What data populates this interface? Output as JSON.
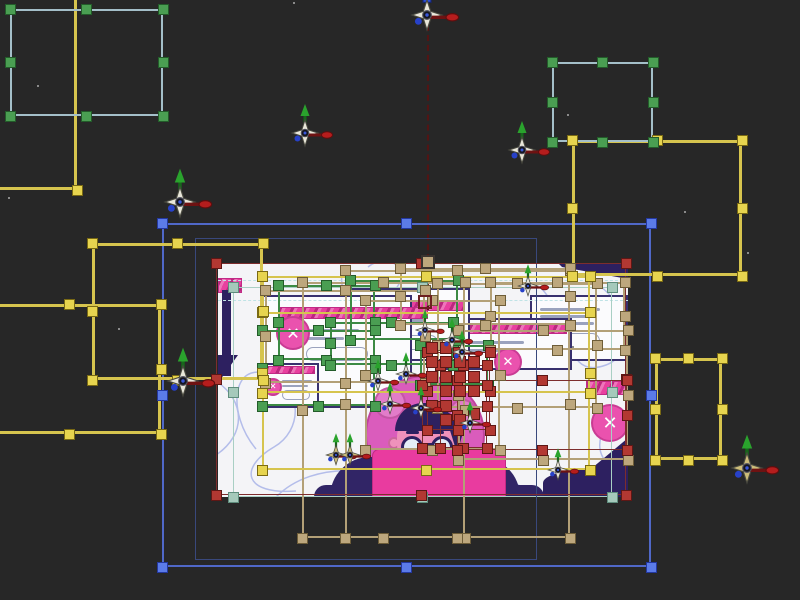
{
  "app": {
    "name": "animation-editor-viewport",
    "background": "#272727",
    "description": "composition viewport with multi-layer selection"
  },
  "artboard": {
    "x": 218,
    "y": 263,
    "w": 410,
    "h": 234,
    "fill": "#f4f4f7"
  },
  "palette": {
    "handle_green": {
      "fill": "#4a9e52",
      "border": "#235c2a"
    },
    "handle_yellow": {
      "fill": "#e7d44f",
      "border": "#7a6a14"
    },
    "handle_khaki": {
      "fill": "#bda77d",
      "border": "#6e5d38"
    },
    "handle_red": {
      "fill": "#b23832",
      "border": "#5e1715"
    },
    "handle_blue": {
      "fill": "#5b7be8",
      "border": "#2438a0"
    },
    "handle_teal": {
      "fill": "#a5c9bb",
      "border": "#5f8d7d"
    },
    "stroke_steel": "#a4bfc9",
    "stroke_yellow": "#d6c44e",
    "stroke_blue": "#5068c8",
    "stroke_navy": "#39487c",
    "stroke_khaki": "#b3a077",
    "stroke_green": "#3c8a44",
    "stroke_red": "#7d2d2d",
    "stroke_teal": "#a9cfc4"
  },
  "selection": {
    "boxes": [
      {
        "id": "teal-artboard-frame",
        "x": 233,
        "y": 287,
        "w": 379,
        "h": 210,
        "stroke": "#a9cfc4",
        "sw": 1,
        "handle": "handle_teal",
        "handles": "all"
      },
      {
        "id": "navy-inner-frame",
        "x": 195,
        "y": 238,
        "w": 342,
        "h": 322,
        "stroke": "#39487c",
        "sw": 1,
        "handle": "handle_blue",
        "handles": "none"
      },
      {
        "id": "green-box-1",
        "x": 278,
        "y": 285,
        "w": 97,
        "h": 75,
        "stroke": "#3c8a44",
        "sw": 2,
        "handle": "handle_green",
        "handles": "all"
      },
      {
        "id": "green-box-2",
        "x": 262,
        "y": 330,
        "w": 113,
        "h": 76,
        "stroke": "#3c8a44",
        "sw": 2,
        "handle": "handle_green",
        "handles": "all"
      },
      {
        "id": "green-box-3",
        "x": 330,
        "y": 322,
        "w": 123,
        "h": 43,
        "stroke": "#3c8a44",
        "sw": 2,
        "handle": "handle_green",
        "handles": "all"
      },
      {
        "id": "green-box-4",
        "x": 350,
        "y": 280,
        "w": 108,
        "h": 60,
        "stroke": "#3c8a44",
        "sw": 2,
        "handle": "handle_green",
        "handles": "corners"
      },
      {
        "id": "green-box-5",
        "x": 420,
        "y": 345,
        "w": 68,
        "h": 40,
        "stroke": "#3c8a44",
        "sw": 2,
        "handle": "handle_green",
        "handles": "corners"
      },
      {
        "id": "khaki-box-1",
        "x": 302,
        "y": 282,
        "w": 163,
        "h": 256,
        "stroke": "#b3a077",
        "sw": 2,
        "handle": "handle_khaki",
        "handles": "all"
      },
      {
        "id": "khaki-box-2",
        "x": 345,
        "y": 270,
        "w": 225,
        "h": 268,
        "stroke": "#b3a077",
        "sw": 2,
        "handle": "handle_khaki",
        "handles": "all"
      },
      {
        "id": "khaki-box-3",
        "x": 365,
        "y": 300,
        "w": 135,
        "h": 150,
        "stroke": "#b3a077",
        "sw": 2,
        "handle": "handle_khaki",
        "handles": "all"
      },
      {
        "id": "khaki-box-4",
        "x": 437,
        "y": 283,
        "w": 160,
        "h": 125,
        "stroke": "#b3a077",
        "sw": 2,
        "handle": "handle_khaki",
        "handles": "all"
      },
      {
        "id": "khaki-box-5",
        "x": 458,
        "y": 330,
        "w": 170,
        "h": 130,
        "stroke": "#b3a077",
        "sw": 2,
        "handle": "handle_khaki",
        "handles": "all"
      },
      {
        "id": "khaki-box-6",
        "x": 490,
        "y": 282,
        "w": 135,
        "h": 68,
        "stroke": "#b3a077",
        "sw": 2,
        "handle": "handle_khaki",
        "handles": "all"
      },
      {
        "id": "khaki-box-7",
        "x": 265,
        "y": 290,
        "w": 160,
        "h": 93,
        "stroke": "#b3a077",
        "sw": 2,
        "handle": "handle_khaki",
        "handles": "all"
      },
      {
        "id": "khaki-box-8",
        "x": 400,
        "y": 268,
        "w": 170,
        "h": 57,
        "stroke": "#b3a077",
        "sw": 2,
        "handle": "handle_khaki",
        "handles": "all"
      },
      {
        "id": "yellow-inner-1",
        "x": 262,
        "y": 276,
        "w": 328,
        "h": 194,
        "stroke": "#d6c44e",
        "sw": 2,
        "handle": "handle_yellow",
        "handles": "all"
      },
      {
        "id": "yellow-inner-2",
        "x": 262,
        "y": 312,
        "w": 328,
        "h": 81,
        "stroke": "#d6c44e",
        "sw": 2,
        "handle": "handle_yellow",
        "handles": "corners"
      },
      {
        "id": "red-artboard-selection",
        "x": 216,
        "y": 263,
        "w": 410,
        "h": 232,
        "stroke": "#7d2d2d",
        "sw": 1,
        "handle": "handle_red",
        "handles": "all"
      },
      {
        "id": "red-box-2",
        "x": 427,
        "y": 352,
        "w": 63,
        "h": 78,
        "stroke": "#7d2d2d",
        "sw": 1,
        "handle": "handle_red",
        "handles": "all"
      },
      {
        "id": "red-box-3",
        "x": 440,
        "y": 365,
        "w": 47,
        "h": 83,
        "stroke": "#7d2d2d",
        "sw": 1,
        "handle": "handle_red",
        "handles": "all"
      },
      {
        "id": "red-box-4",
        "x": 422,
        "y": 385,
        "w": 65,
        "h": 63,
        "stroke": "#7d2d2d",
        "sw": 1,
        "handle": "handle_red",
        "handles": "corners"
      },
      {
        "id": "red-box-5",
        "x": 457,
        "y": 380,
        "w": 170,
        "h": 70,
        "stroke": "#7d2d2d",
        "sw": 1,
        "handle": "handle_red",
        "handles": "all"
      },
      {
        "id": "blue-main-box",
        "x": 162,
        "y": 223,
        "w": 489,
        "h": 344,
        "stroke": "#5068c8",
        "sw": 2,
        "handle": "handle_blue",
        "handles": "all"
      },
      {
        "id": "yellow-topleft-L",
        "x": -263,
        "y": -180,
        "w": 340,
        "h": 370,
        "stroke": "#d6c44e",
        "sw": 3,
        "handle": "handle_yellow",
        "handles": "corners"
      },
      {
        "id": "yellow-midleft-box",
        "x": 92,
        "y": 243,
        "w": 171,
        "h": 137,
        "stroke": "#d6c44e",
        "sw": 3,
        "handle": "handle_yellow",
        "handles": "all"
      },
      {
        "id": "yellow-left-L",
        "x": -22,
        "y": 304,
        "w": 183,
        "h": 130,
        "stroke": "#d6c44e",
        "sw": 3,
        "handle": "handle_yellow",
        "handles": "all"
      },
      {
        "id": "yellow-topright-box",
        "x": 572,
        "y": 140,
        "w": 170,
        "h": 136,
        "stroke": "#d6c44e",
        "sw": 3,
        "handle": "handle_yellow",
        "handles": "all"
      },
      {
        "id": "yellow-right-box",
        "x": 655,
        "y": 358,
        "w": 67,
        "h": 102,
        "stroke": "#d6c44e",
        "sw": 3,
        "handle": "handle_yellow",
        "handles": "all"
      },
      {
        "id": "steel-topleft-box",
        "x": 10,
        "y": 9,
        "w": 153,
        "h": 107,
        "stroke": "#a4bfc9",
        "sw": 2,
        "handle": "handle_green",
        "handles": "all"
      },
      {
        "id": "steel-topright-box",
        "x": 552,
        "y": 62,
        "w": 101,
        "h": 80,
        "stroke": "#a4bfc9",
        "sw": 2,
        "handle": "handle_green",
        "handles": "all"
      }
    ],
    "red_blocks": [
      [
        432,
        348
      ],
      [
        446,
        348
      ],
      [
        432,
        362
      ],
      [
        446,
        362
      ],
      [
        460,
        362
      ],
      [
        474,
        362
      ],
      [
        432,
        377
      ],
      [
        446,
        377
      ],
      [
        460,
        377
      ],
      [
        474,
        377
      ],
      [
        446,
        391
      ],
      [
        460,
        391
      ],
      [
        474,
        391
      ],
      [
        432,
        406
      ],
      [
        446,
        406
      ],
      [
        446,
        420
      ],
      [
        460,
        420
      ],
      [
        474,
        414
      ]
    ],
    "anchors": [
      {
        "x": 421,
        "y": 255,
        "w": 14,
        "h": 14,
        "stroke": "#3a3430",
        "fill": "#bda77d"
      },
      {
        "x": 418,
        "y": 295,
        "w": 14,
        "h": 14,
        "stroke": "#6e2020",
        "fill": "transparent"
      }
    ],
    "motion_path": {
      "x": 427,
      "y1": 25,
      "y2": 310,
      "color": "#521414"
    },
    "specks": [
      [
        37,
        85
      ],
      [
        567,
        114
      ],
      [
        118,
        328
      ],
      [
        8,
        197
      ],
      [
        293,
        2
      ],
      [
        684,
        211
      ],
      [
        747,
        252
      ],
      [
        572,
        346
      ]
    ]
  },
  "gizmos": [
    {
      "x": 180,
      "y": 202,
      "s": 1.15,
      "up": "green"
    },
    {
      "x": 427,
      "y": 15,
      "s": 1.15,
      "up": "blue"
    },
    {
      "x": 305,
      "y": 133,
      "s": 1.0,
      "up": "green"
    },
    {
      "x": 522,
      "y": 150,
      "s": 1.0,
      "up": "green"
    },
    {
      "x": 183,
      "y": 381,
      "s": 1.15,
      "up": "green"
    },
    {
      "x": 747,
      "y": 468,
      "s": 1.15,
      "up": "green",
      "star": "#cdbd7a"
    },
    {
      "x": 378,
      "y": 381,
      "s": 0.75,
      "up": "green"
    },
    {
      "x": 390,
      "y": 404,
      "s": 0.75,
      "up": "green"
    },
    {
      "x": 406,
      "y": 374,
      "s": 0.75,
      "up": "green"
    },
    {
      "x": 421,
      "y": 408,
      "s": 0.75,
      "up": "green"
    },
    {
      "x": 452,
      "y": 340,
      "s": 0.75,
      "up": "green"
    },
    {
      "x": 470,
      "y": 423,
      "s": 0.75,
      "up": "green"
    },
    {
      "x": 528,
      "y": 286,
      "s": 0.75,
      "up": "green"
    },
    {
      "x": 558,
      "y": 470,
      "s": 0.75,
      "up": "green"
    },
    {
      "x": 336,
      "y": 455,
      "s": 0.75,
      "up": "green",
      "star": "#cdbd7a"
    },
    {
      "x": 350,
      "y": 455,
      "s": 0.75,
      "up": "green",
      "star": "#cdbd7a"
    },
    {
      "x": 462,
      "y": 352,
      "s": 0.75,
      "up": "green"
    },
    {
      "x": 425,
      "y": 330,
      "s": 0.7,
      "up": "green"
    }
  ],
  "illustration": {
    "curve_stroke": "#b4bdea",
    "curves": [
      "M38,186 C8,150 14,96 52,112 C86,126 84,168 56,184 C20,205 26,232 78,228",
      "M126,2 C114,40 150,56 176,28 C196,6 170,-12 150,4",
      "M58,234 C96,196 168,202 198,234",
      "M322,24 C356,58 344,118 388,102 C416,92 414,44 380,22",
      "M396,152 C368,180 386,214 410,198",
      "M-2,118 C28,138 28,172 -2,192",
      "M228,234 C258,204 300,212 312,234",
      "M212,40 C232,60 224,86 204,92"
    ],
    "items": [
      {
        "t": "pbar",
        "x": 0,
        "y": 15,
        "w": 24,
        "h": 15
      },
      {
        "t": "rect",
        "x": 4,
        "y": 27,
        "w": 9,
        "h": 86,
        "fill": "#2d2060"
      },
      {
        "t": "poly",
        "x": 0,
        "y": 92,
        "w": 22,
        "h": 28,
        "pts": [
          [
            0,
            0
          ],
          [
            20,
            0
          ],
          [
            0,
            28
          ]
        ],
        "fill": "#2d2060"
      },
      {
        "t": "rect",
        "x": 312,
        "y": 32,
        "w": 98,
        "h": 66,
        "fill": "#fbfbfd",
        "stroke": "#38306e"
      },
      {
        "t": "line",
        "x": 322,
        "y": 45,
        "w": 60,
        "h": 3
      },
      {
        "t": "line",
        "x": 322,
        "y": 52,
        "w": 48,
        "h": 3
      },
      {
        "t": "line",
        "x": 322,
        "y": 59,
        "w": 54,
        "h": 3
      },
      {
        "t": "outline",
        "x": 322,
        "y": 70,
        "w": 60,
        "h": 16
      },
      {
        "t": "rect",
        "x": 222,
        "y": 55,
        "w": 132,
        "h": 52,
        "fill": "#fbfbfd",
        "stroke": "#38306e"
      },
      {
        "t": "pbar",
        "x": 227,
        "y": 60,
        "w": 122,
        "h": 11
      },
      {
        "t": "line",
        "x": 236,
        "y": 78,
        "w": 70,
        "h": 3
      },
      {
        "t": "line",
        "x": 236,
        "y": 86,
        "w": 55,
        "h": 3
      },
      {
        "t": "circle",
        "x": 290,
        "y": 99,
        "r": 14,
        "fill": "#ea52ae",
        "glyph": "✕"
      },
      {
        "t": "rect",
        "x": 132,
        "y": 25,
        "w": 120,
        "h": 73,
        "fill": "#fbfbfd",
        "stroke": "#38306e"
      },
      {
        "t": "pbar",
        "x": 137,
        "y": 37,
        "w": 110,
        "h": 11
      },
      {
        "t": "line",
        "x": 146,
        "y": 56,
        "w": 60,
        "h": 3
      },
      {
        "t": "line",
        "x": 146,
        "y": 63,
        "w": 45,
        "h": 3
      },
      {
        "t": "outline",
        "x": 150,
        "y": 72,
        "w": 70,
        "h": 15
      },
      {
        "t": "circle",
        "x": 163,
        "y": 68,
        "r": 10,
        "fill": "#ea52ae"
      },
      {
        "t": "rect",
        "x": 44,
        "y": 32,
        "w": 150,
        "h": 113,
        "fill": "#fbfbfd",
        "stroke": "#38306e"
      },
      {
        "t": "pbar",
        "x": 60,
        "y": 44,
        "w": 150,
        "h": 12
      },
      {
        "t": "line",
        "x": 86,
        "y": 66,
        "w": 55,
        "h": 3
      },
      {
        "t": "line",
        "x": 86,
        "y": 74,
        "w": 40,
        "h": 3
      },
      {
        "t": "outline",
        "x": 88,
        "y": 84,
        "w": 62,
        "h": 14
      },
      {
        "t": "circle",
        "x": 75,
        "y": 70,
        "r": 17,
        "fill": "#ea52ae",
        "glyph": "✕"
      },
      {
        "t": "rect",
        "x": 44,
        "y": 100,
        "w": 57,
        "h": 43,
        "fill": "#fbfbfd",
        "stroke": "#38306e"
      },
      {
        "t": "pbar",
        "x": 47,
        "y": 103,
        "w": 50,
        "h": 8
      },
      {
        "t": "line",
        "x": 64,
        "y": 117,
        "w": 30,
        "h": 2
      },
      {
        "t": "line",
        "x": 64,
        "y": 122,
        "w": 26,
        "h": 2
      },
      {
        "t": "outline",
        "x": 64,
        "y": 127,
        "w": 28,
        "h": 10
      },
      {
        "t": "circle",
        "x": 55,
        "y": 124,
        "r": 9,
        "fill": "#ea52ae",
        "glyph": "✕"
      },
      {
        "t": "poly",
        "x": 340,
        "y": 0,
        "w": 70,
        "h": 16,
        "pts": [
          [
            0,
            0
          ],
          [
            70,
            0
          ],
          [
            70,
            16
          ],
          [
            4,
            4
          ]
        ],
        "fill": "#2d2060"
      },
      {
        "t": "pbar",
        "x": 368,
        "y": 118,
        "w": 42,
        "h": 14
      },
      {
        "t": "circle",
        "x": 392,
        "y": 160,
        "r": 19,
        "fill": "#ea52ae",
        "glyph": "✕"
      },
      {
        "t": "poly",
        "x": 362,
        "y": 175,
        "w": 48,
        "h": 40,
        "pts": [
          [
            48,
            0
          ],
          [
            48,
            40
          ],
          [
            0,
            40
          ]
        ],
        "fill": "#2d2060"
      },
      {
        "t": "rect",
        "x": 325,
        "y": 206,
        "w": 100,
        "h": 28,
        "fill": "#2d2060",
        "rx": "50% 50% 0 0"
      },
      {
        "t": "circle",
        "x": 207,
        "y": 172,
        "r": 60,
        "fill": "#da5cbc"
      },
      {
        "t": "circle",
        "x": 172,
        "y": 140,
        "r": 16,
        "fill": "#e27cc9"
      },
      {
        "t": "circle",
        "x": 245,
        "y": 150,
        "r": 14,
        "fill": "#e27cc9"
      },
      {
        "t": "circle",
        "x": 176,
        "y": 180,
        "r": 6,
        "fill": "#ef92bb"
      },
      {
        "t": "circle",
        "x": 238,
        "y": 180,
        "r": 6,
        "fill": "#ef92bb"
      },
      {
        "t": "rect",
        "x": 179,
        "y": 148,
        "w": 56,
        "h": 54,
        "fill": "#ef92bb",
        "rx": "26px 26px 20px 20px"
      },
      {
        "t": "rect",
        "x": 177,
        "y": 140,
        "w": 60,
        "h": 28,
        "fill": "#2d2060",
        "rx": "28px 28px 0 0"
      },
      {
        "t": "poly",
        "x": 225,
        "y": 145,
        "w": 22,
        "h": 45,
        "pts": [
          [
            0,
            0
          ],
          [
            22,
            18
          ],
          [
            14,
            45
          ]
        ],
        "fill": "#2d2060"
      },
      {
        "t": "rect",
        "x": 188,
        "y": 168,
        "w": 13,
        "h": 3,
        "fill": "#2d2060",
        "rx": "2px"
      },
      {
        "t": "rect",
        "x": 213,
        "y": 168,
        "w": 13,
        "h": 3,
        "fill": "#2d2060",
        "rx": "2px"
      },
      {
        "t": "circle",
        "x": 194,
        "y": 184,
        "r": 11,
        "fill": "#e4edf6",
        "stroke": "#2d2060",
        "sw": 3
      },
      {
        "t": "circle",
        "x": 224,
        "y": 184,
        "r": 11,
        "fill": "#e4edf6",
        "stroke": "#2d2060",
        "sw": 3
      },
      {
        "t": "rect",
        "x": 204,
        "y": 180,
        "w": 10,
        "h": 3,
        "fill": "#2d2060"
      },
      {
        "t": "rect",
        "x": 112,
        "y": 194,
        "w": 190,
        "h": 40,
        "fill": "#312566",
        "rx": "80px 80px 0 0"
      },
      {
        "t": "rect",
        "x": 96,
        "y": 222,
        "w": 230,
        "h": 12,
        "fill": "#312566",
        "rx": "26px 26px 0 0"
      },
      {
        "t": "rect",
        "x": 154,
        "y": 186,
        "w": 134,
        "h": 48,
        "fill": "#e93b9f",
        "rx": "7px 7px 0 0",
        "stroke": "#c22a84",
        "sw": 1
      },
      {
        "t": "guide",
        "x": 0,
        "y": 17,
        "w": 410
      },
      {
        "t": "guide",
        "x": 0,
        "y": 37,
        "w": 410
      }
    ]
  }
}
